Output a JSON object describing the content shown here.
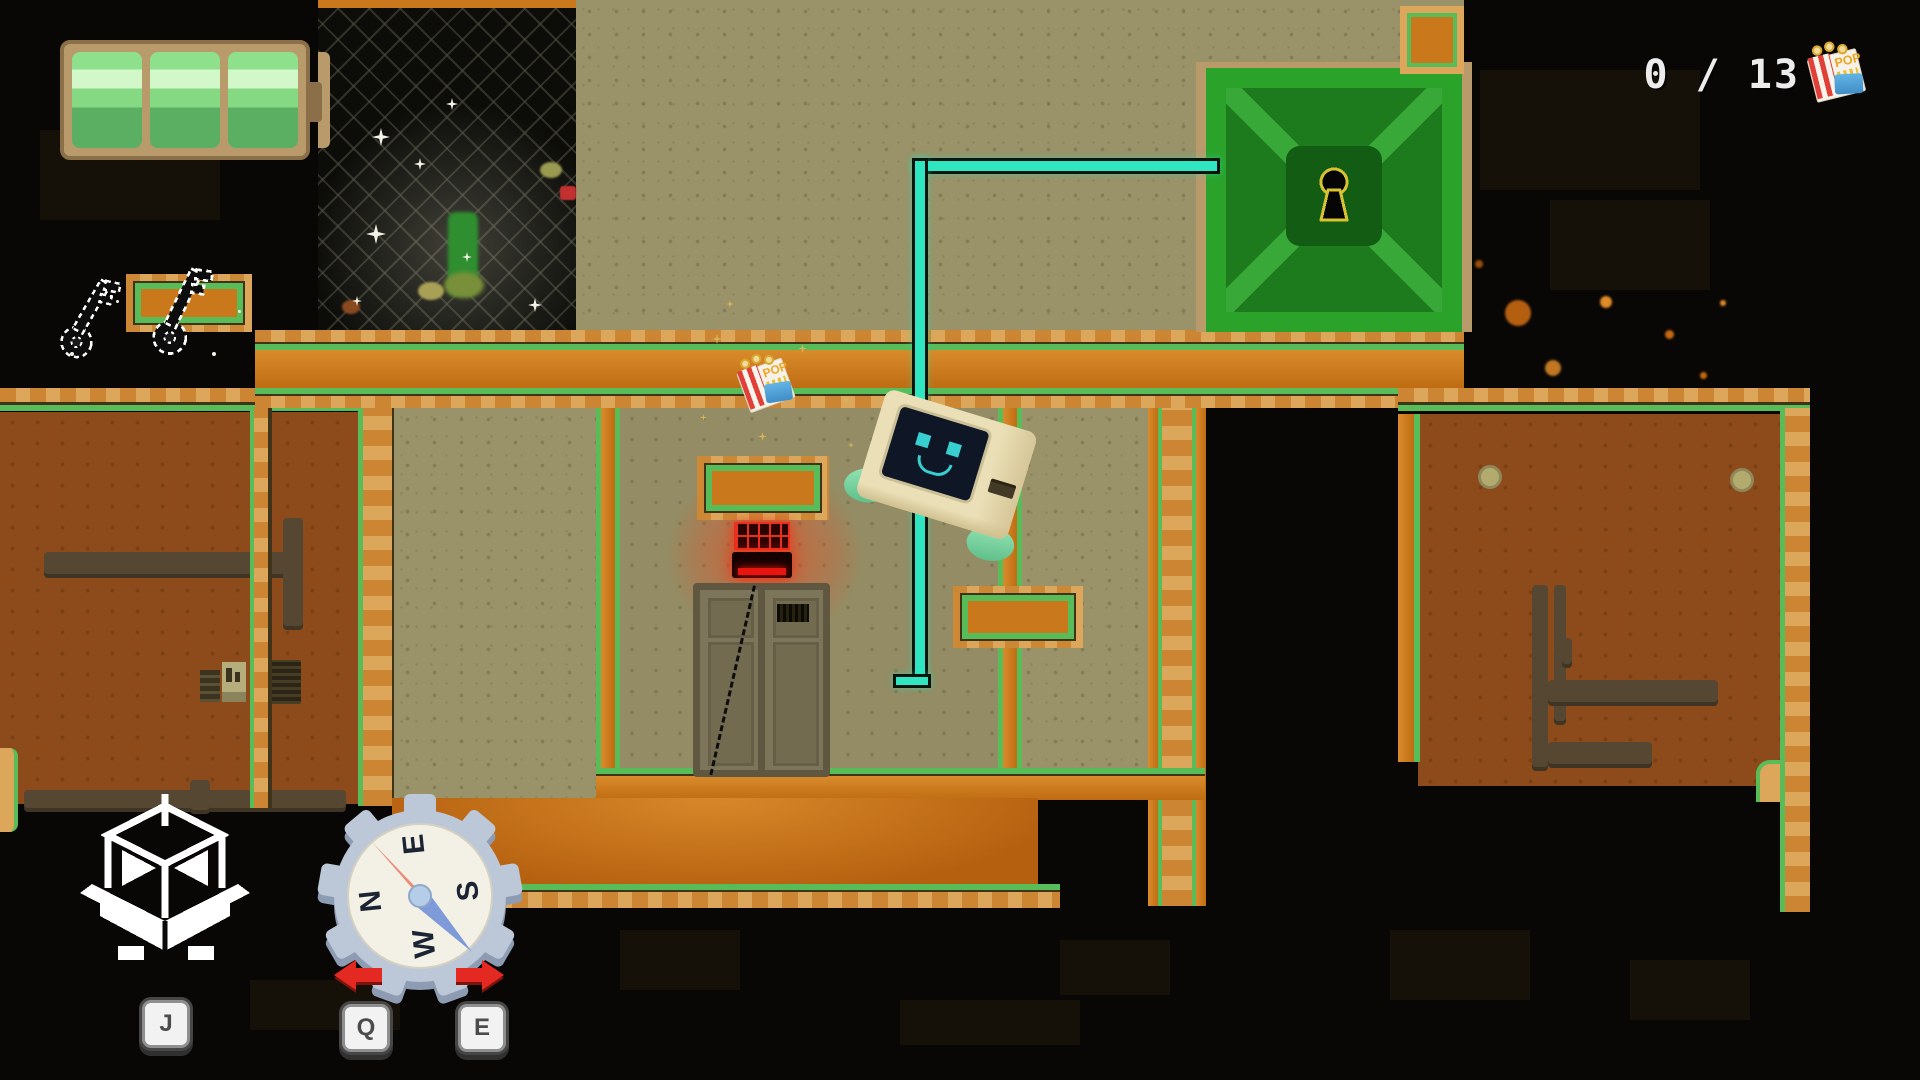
{
  "hud": {
    "battery": {
      "segments_total": 3,
      "segments_filled": 3
    },
    "keys": {
      "count": 2
    },
    "popcorn_counter": {
      "value": "0 / 13",
      "collected": 0,
      "total": 13
    },
    "popcorn_label": "POP",
    "controls": {
      "place_block_key": "J",
      "rotate_left_key": "Q",
      "rotate_right_key": "E"
    },
    "compass": {
      "n": "N",
      "e": "E",
      "s": "S",
      "w": "W"
    }
  },
  "colors": {
    "rope_teal": "#2fe6c0",
    "hatch_green": "#2ba32b",
    "trim_green": "#58bd58",
    "beam_orange": "#c9781c",
    "turret_red": "#e83020",
    "battery_green": "#8fe08d",
    "wall_tan": "#9a9268",
    "room_rust": "#8d4a1a",
    "arrow_red": "#e42822"
  },
  "icons": [
    "battery-icon",
    "key-icon",
    "popcorn-icon",
    "keyhole-icon",
    "place-block-icon",
    "compass-icon",
    "arrow-left-icon",
    "arrow-right-icon"
  ]
}
